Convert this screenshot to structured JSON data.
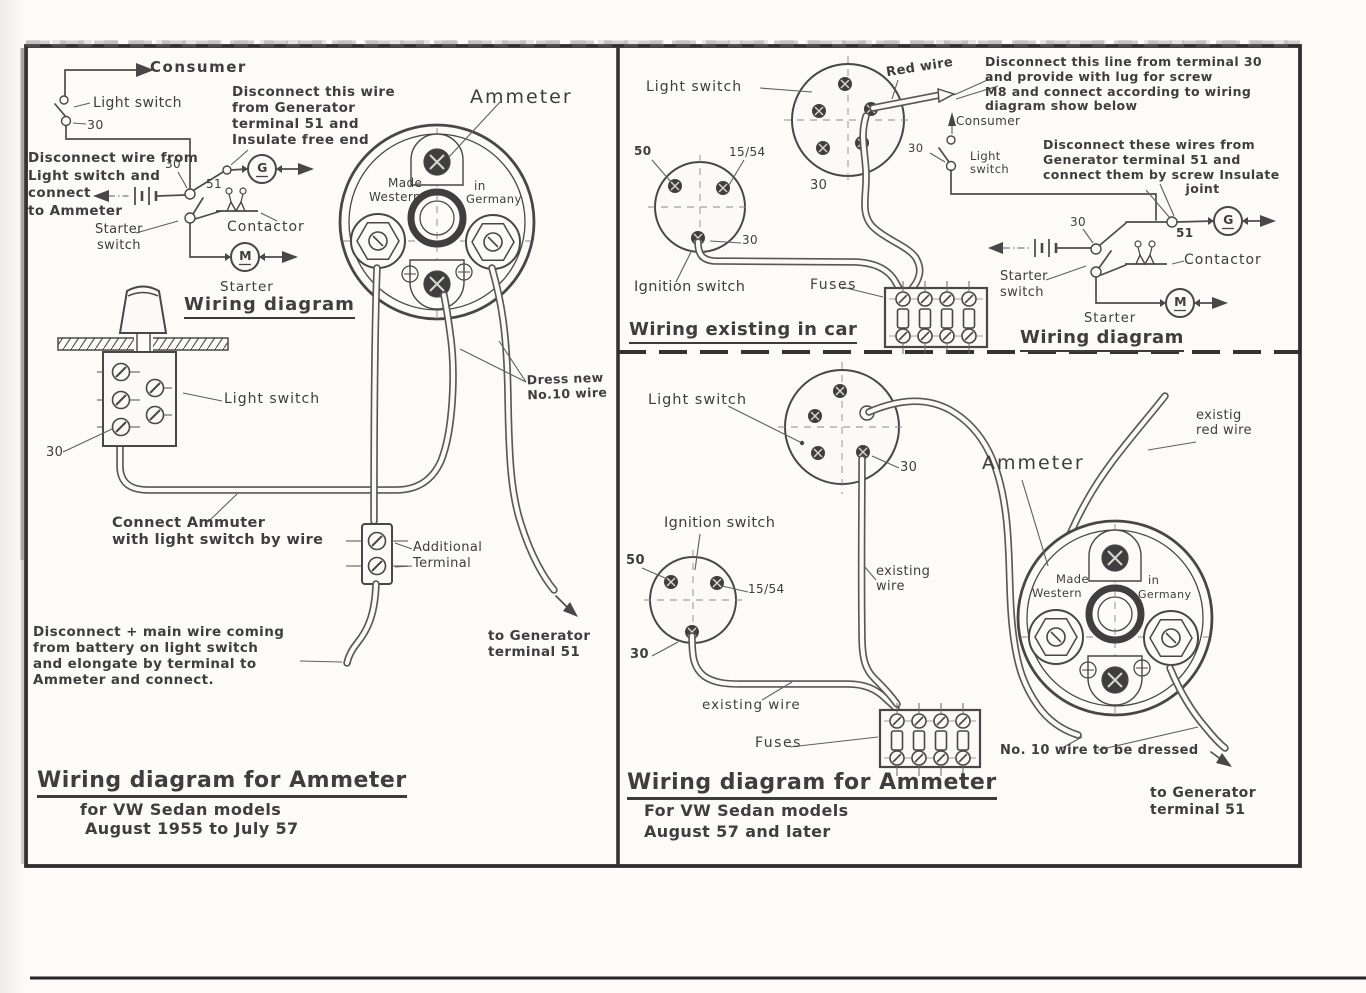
{
  "colors": {
    "paper": "#fbfaf8",
    "ink": "#3e3e3e",
    "frame": "#2f2f2f"
  },
  "ammeter_face": {
    "made": "Made",
    "western": "Western",
    "in_word": "in",
    "germany": "Germany"
  },
  "panel_1955": {
    "schematic": {
      "consumer": "Consumer",
      "light_switch": "Light switch",
      "n30_switch": "30",
      "n30_node": "30",
      "n51": "51",
      "starter_switch": "Starter\nswitch",
      "contactor": "Contactor",
      "generator_letter": "G",
      "motor_letter": "M",
      "starter": "Starter",
      "section_title": "Wiring diagram"
    },
    "ammeter_label": "Ammeter",
    "notes": {
      "disconnect_generator": "Disconnect this wire\nfrom Generator\nterminal 51 and\nInsulate free end",
      "disconnect_light_switch": "Disconnect wire from\nLight switch and\nconnect\nto Ammeter",
      "connect_ammeter": "Connect Ammuter\nwith light switch by wire",
      "dress_new_wire": "Dress new\nNo.10 wire",
      "additional_terminal": "Additional\nTerminal",
      "to_generator": "to Generator\nterminal 51",
      "disconnect_main": "Disconnect + main wire coming\nfrom battery on light switch\nand elongate by terminal to\nAmmeter and connect."
    },
    "light_switch_drawing": {
      "label": "Light switch",
      "n30": "30"
    },
    "footer": {
      "title": "Wiring diagram for Ammeter",
      "line1": "for VW Sedan models",
      "line2": "August 1955 to July 57"
    }
  },
  "panel_existing": {
    "light_switch": "Light switch",
    "red_wire": "Red wire",
    "n30_light": "30",
    "n50": "50",
    "n1554": "15/54",
    "n30_ign": "30",
    "ignition_switch": "Ignition switch",
    "fuses": "Fuses",
    "section_title": "Wiring existing in car"
  },
  "panel_new_wiring": {
    "note_terminal30": "Disconnect this line from terminal 30\nand provide with lug for screw\nM8 and connect according to wiring\ndiagram show below",
    "note_terminal51": "Disconnect these wires from\nGenerator terminal 51 and\nconnect them by screw Insulate\n                              joint",
    "consumer": "Consumer",
    "n30_consumer": "30",
    "light_switch": "Light\nswitch",
    "n30_battery": "30",
    "n51": "51",
    "generator_letter": "G",
    "contactor": "Contactor",
    "starter_switch": "Starter\nswitch",
    "starter": "Starter",
    "motor_letter": "M",
    "section_title": "Wiring diagram"
  },
  "panel_later": {
    "light_switch": "Light switch",
    "n30_light": "30",
    "ignition_switch": "Ignition switch",
    "n50": "50",
    "n1554": "15/54",
    "n30_ign": "30",
    "ammeter_label": "Ammeter",
    "existing_red_wire": "existig\nred wire",
    "existing_wire_vertical": "existing\nwire",
    "existing_wire_horizontal": "existing wire",
    "fuses": "Fuses",
    "no10_note": "No. 10 wire to be dressed",
    "to_generator": "to Generator\nterminal 51",
    "footer": {
      "title": "Wiring diagram for Ammeter",
      "line1": "For VW Sedan models",
      "line2": "August 57 and later"
    }
  }
}
